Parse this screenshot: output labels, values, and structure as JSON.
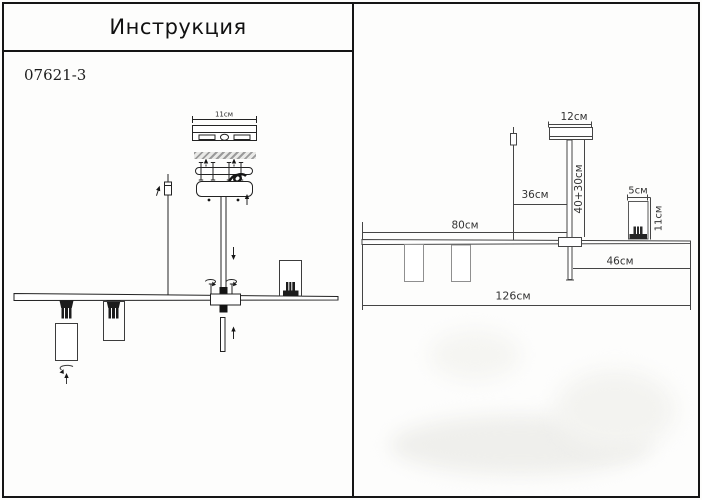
{
  "header": {
    "title": "Инструкция",
    "model": "07621-3"
  },
  "left_panel": {
    "labels": {
      "plate_width": "11см"
    }
  },
  "right_panel": {
    "labels": {
      "canopy_width": "12см",
      "rod_length": "40+30см",
      "cable_length": "36см",
      "left_section": "80см",
      "spot_width": "5см",
      "spot_height": "11см",
      "right_section": "46см",
      "total_width": "126см"
    }
  },
  "colors": {
    "line_dark": "#232323",
    "line_gray": "#454545",
    "shade_gray": "#8f8f8f",
    "text": "#333333"
  }
}
